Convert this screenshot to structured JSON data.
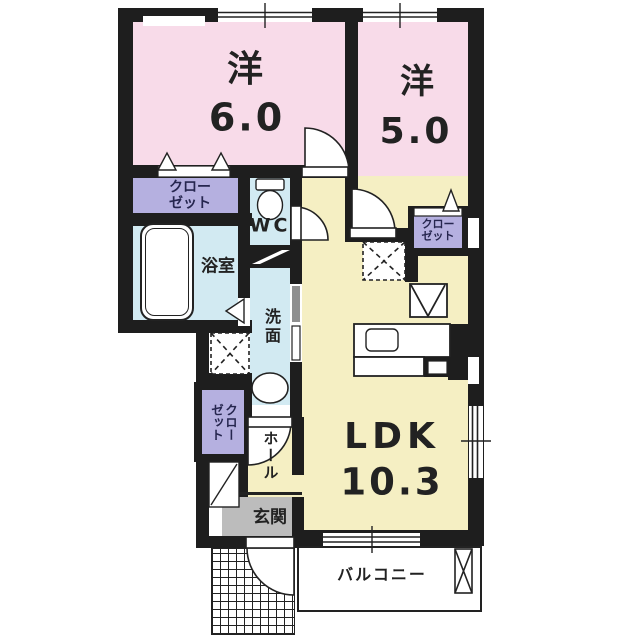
{
  "colors": {
    "pink": "#f8dbe9",
    "yellow": "#f5efc3",
    "cyan": "#d2eaf2",
    "lavender": "#b5b0e0",
    "gray": "#bcbcbc",
    "slider-gray": "#8f8f8f",
    "wall": "#1e1e1e",
    "ink": "#222222",
    "closet-ink": "#26264f"
  },
  "rooms": {
    "western6": {
      "name": "洋",
      "size": "6.0"
    },
    "western5": {
      "name": "洋",
      "size": "5.0"
    },
    "ldk": {
      "name": "LDK",
      "size": "10.3"
    },
    "bath": {
      "label": "浴室"
    },
    "wc": {
      "label": "WC"
    },
    "washroom": {
      "label": "洗面"
    },
    "hall": {
      "label": "ホール"
    },
    "entrance": {
      "label": "玄関"
    },
    "balcony": {
      "label": "バルコニー"
    }
  },
  "closets": {
    "west6": {
      "line1": "クロー",
      "line2": "ゼット"
    },
    "west5": {
      "line1": "クロー",
      "line2": "ゼット"
    },
    "hall": {
      "line1": "クロー",
      "line2": "ゼット"
    }
  }
}
